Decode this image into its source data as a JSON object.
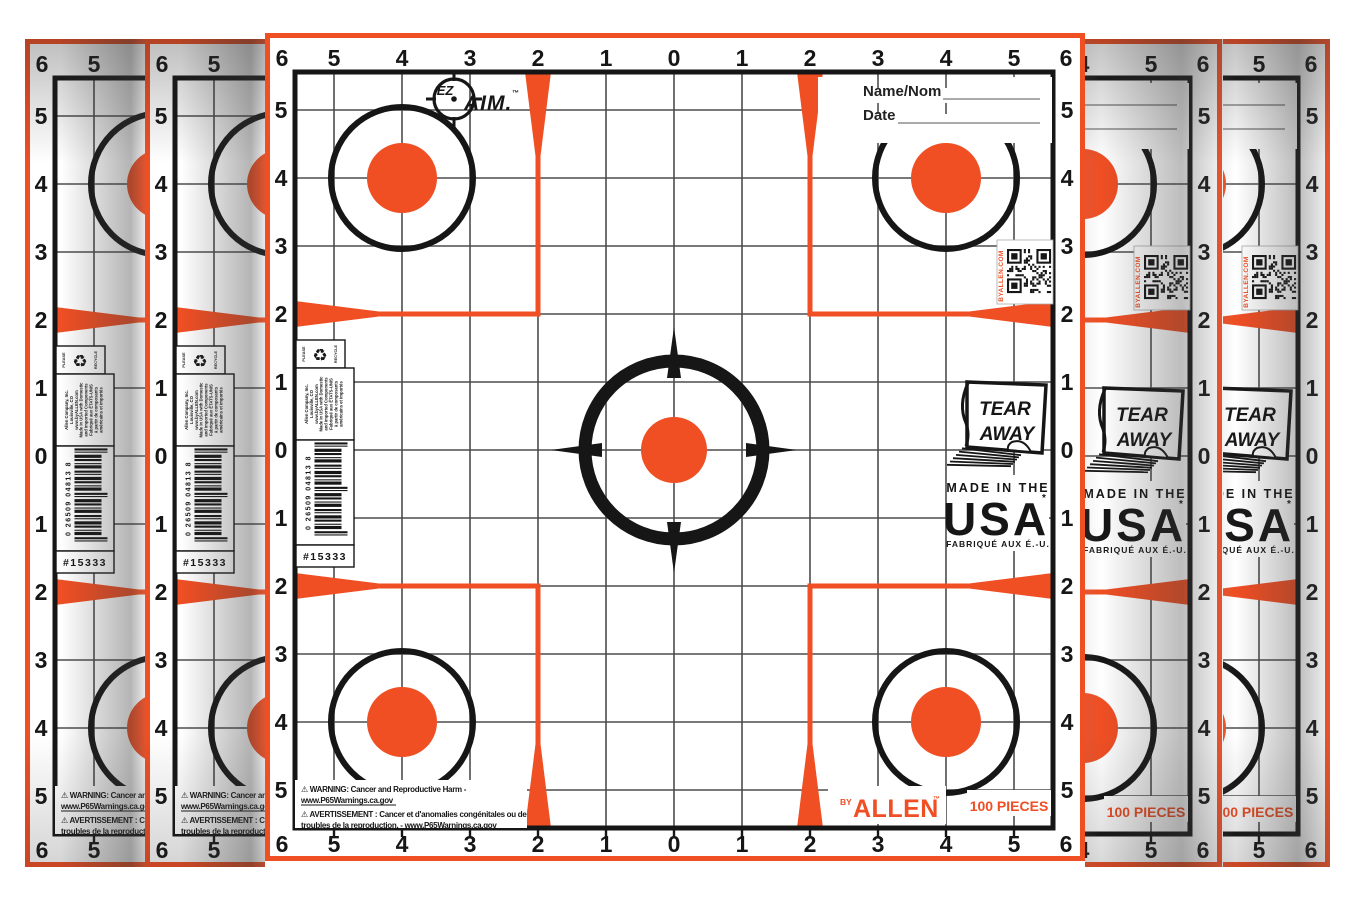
{
  "colors": {
    "orange": "#F04E23",
    "ink": "#161616",
    "grid": "#4d4d4d",
    "line_gray": "#777777"
  },
  "sheet": {
    "corner_label": "6",
    "edge_labels": [
      "5",
      "4",
      "3",
      "2",
      "1",
      "0",
      "1",
      "2",
      "3",
      "4",
      "5"
    ],
    "logo": {
      "ez": "EZ",
      "aim": "AIM.",
      "tm": "™"
    },
    "name_field": {
      "label": "Name/Nom"
    },
    "date_field": {
      "label": "Date"
    },
    "qr_caption": "BYALLEN.COM",
    "tear_away": {
      "line1": "TEAR",
      "line2": "AWAY"
    },
    "made_in": {
      "line1": "MADE IN THE",
      "line2": "USA",
      "mark": "*",
      "line3": "FABRIQUÉ AUX É.-U."
    },
    "recycle": {
      "left": "PLEASE",
      "right": "RECYCLE",
      "icon": "♻"
    },
    "company_lines": [
      "Allen Company, Inc.",
      "Louisville, CO",
      "www.byALLEN.com",
      "Made in USA with Domestic",
      "and Imported Components",
      "Fabriqué aux ÉTATS-UNIS",
      "à partir de composants",
      "américains et importés"
    ],
    "upc": "0 26509 04813 8",
    "item_number": "#15333",
    "warnings": {
      "en_line1": "⚠ WARNING: Cancer and Reproductive Harm -",
      "en_line2": "www.P65Warnings.ca.gov",
      "fr_line1": "⚠ AVERTISSEMENT : Cancer et d'anomalies congénitales ou de",
      "fr_line2": "troubles de la reproduction. - ",
      "fr_line2_url": "www.P65Warnings.ca.gov"
    },
    "brand": {
      "by": "BY",
      "name": "ALLEN",
      "tm": "™"
    },
    "pieces": "100 PIECES"
  }
}
